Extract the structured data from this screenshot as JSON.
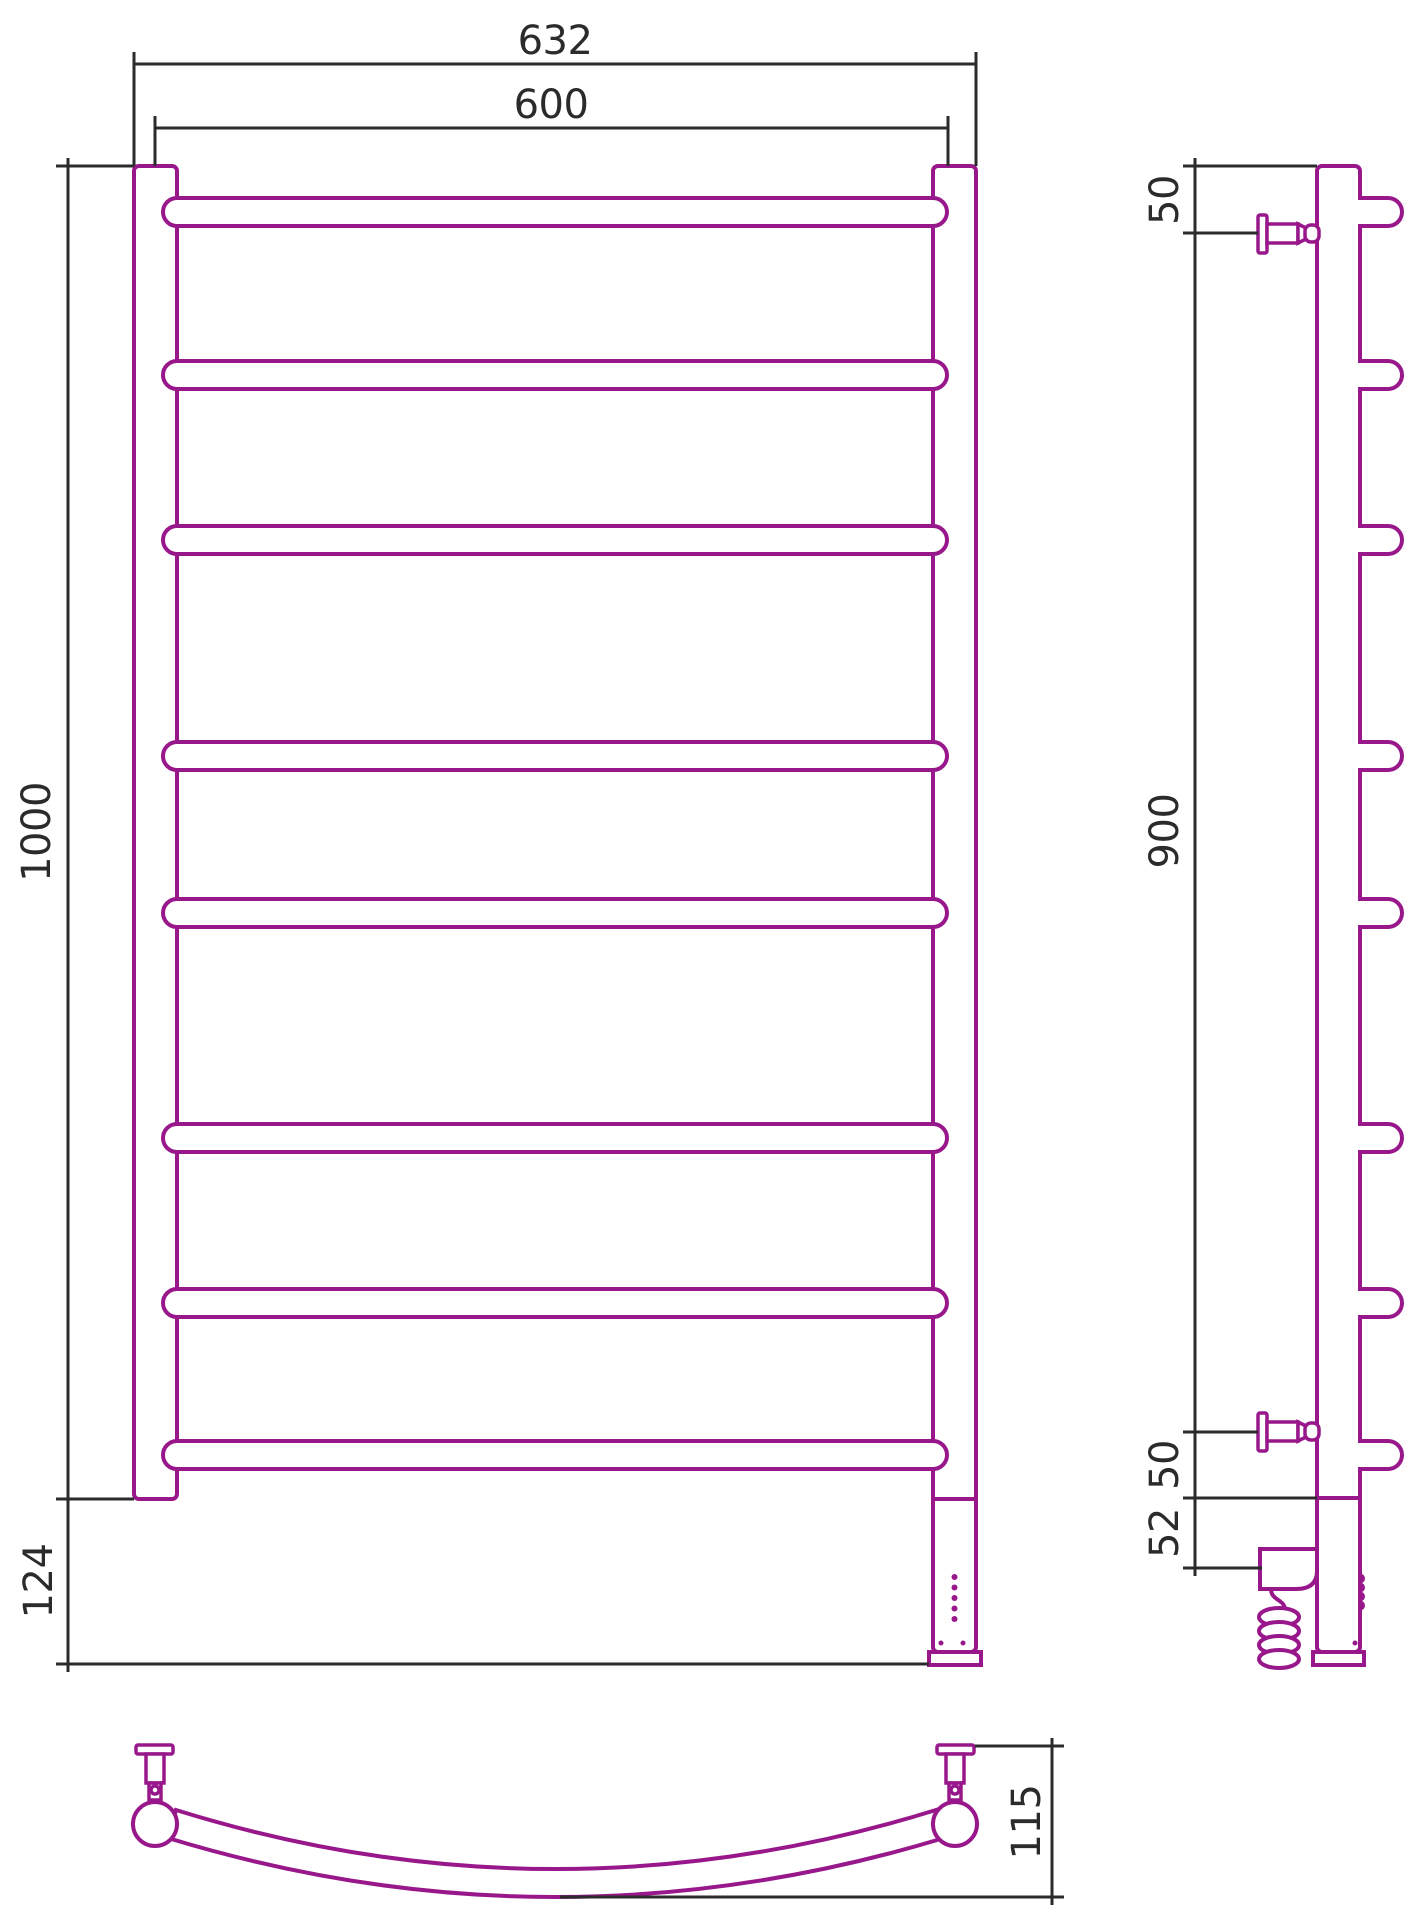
{
  "document": {
    "type": "technical-drawing",
    "subject": "ladder towel rail with electric heating element",
    "views": [
      "front",
      "side",
      "plan"
    ]
  },
  "colors": {
    "product_line": "#98188C",
    "dimension_line": "#2b2b2b",
    "background": "#ffffff"
  },
  "dimensions": {
    "front": {
      "overall_width": "632",
      "rail_width": "600",
      "overall_height": "1000",
      "bottom_section_height": "124"
    },
    "side": {
      "top_bracket_offset": "50",
      "bracket_span": "900",
      "bottom_bracket_offset": "50",
      "bottom_unit_height": "52"
    },
    "plan": {
      "depth": "115"
    }
  },
  "chart_data": {
    "type": "table",
    "title": "",
    "bar_count": 8,
    "bar_centers_y": [
      212,
      375,
      540,
      756,
      913,
      1138,
      1303,
      1455
    ],
    "bar_radius": 14,
    "front_posts_x": {
      "left_outer": 134,
      "left_inner": 177,
      "right_inner": 933,
      "right_outer": 976
    },
    "side_rail_x": {
      "left": 1317,
      "right": 1360
    },
    "indicator_dots_y": [
      1577,
      1587.5,
      1598,
      1608.5,
      1619
    ]
  }
}
